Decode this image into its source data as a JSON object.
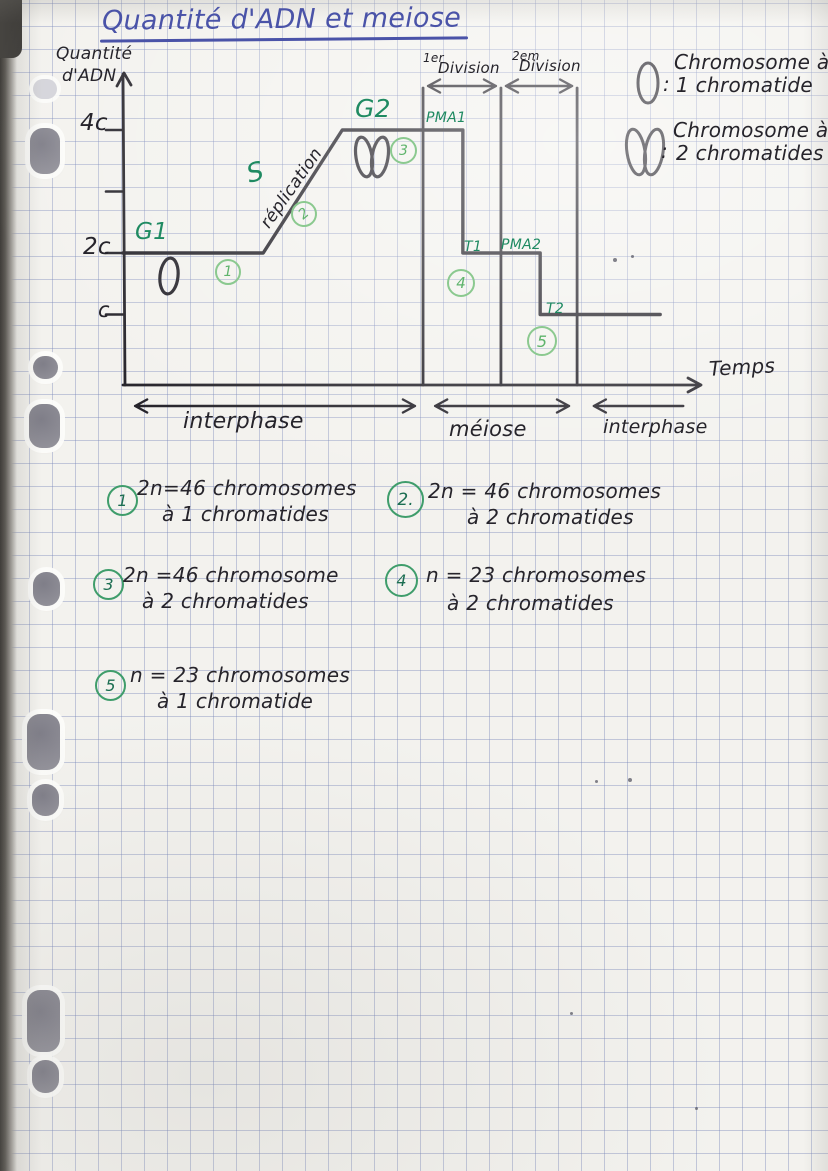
{
  "title": "Quantité d'ADN et meiose",
  "y_axis": {
    "label_line1": "Quantité",
    "label_line2": "d'ADN",
    "tick_labels": [
      "4c",
      "2c",
      "c"
    ]
  },
  "x_axis": {
    "label": "Temps"
  },
  "divisions": [
    {
      "ordinal": "1er",
      "word": "Division"
    },
    {
      "ordinal": "2em",
      "word": "Division"
    }
  ],
  "phases": {
    "g1": "G1",
    "s": "S",
    "replication": "réplication",
    "g2": "G2",
    "pma1": "PMA1",
    "t1": "T1",
    "pma2": "PMA2",
    "t2": "T2"
  },
  "spans": [
    {
      "label": "interphase"
    },
    {
      "label": "méiose"
    },
    {
      "label": "interphase"
    }
  ],
  "graph_marks": [
    "1",
    "2",
    "3",
    "4",
    "5"
  ],
  "legend": [
    {
      "symbol": "chromosome-1-chromatide",
      "separator": ":",
      "line1": "Chromosome à",
      "line2": "1 chromatide"
    },
    {
      "symbol": "chromosome-2-chromatides",
      "separator": ":",
      "line1": "Chromosome à",
      "line2": "2 chromatides"
    }
  ],
  "notes": [
    {
      "num": "1",
      "line1": "2n=46 chromosomes",
      "line2": "à 1 chromatides"
    },
    {
      "num": "2.",
      "line1": "2n = 46 chromosomes",
      "line2": "à 2 chromatides"
    },
    {
      "num": "3",
      "line1": "2n =46 chromosome",
      "line2": "à 2 chromatides"
    },
    {
      "num": "4",
      "line1": "n = 23 chromosomes",
      "line2": "à 2 chromatides"
    },
    {
      "num": "5",
      "line1": "n = 23 chromosomes",
      "line2": "à 1 chromatide"
    }
  ],
  "chart_data": {
    "type": "line",
    "title": "Quantité d'ADN et meiose",
    "xlabel": "Temps",
    "ylabel": "Quantité d'ADN",
    "y_ticks": [
      {
        "label": "4c",
        "value": 4
      },
      {
        "label": "",
        "value": 3
      },
      {
        "label": "2c",
        "value": 2
      },
      {
        "label": "c",
        "value": 1
      }
    ],
    "ylim": [
      0,
      4.8
    ],
    "x_unit": "temps (échelle arbitraire 0–100, non graduée)",
    "points": [
      [
        0,
        2
      ],
      [
        24.3,
        2
      ],
      [
        38,
        4
      ],
      [
        58.9,
        4
      ],
      [
        58.9,
        2
      ],
      [
        72.3,
        2
      ],
      [
        72.3,
        1
      ],
      [
        93.1,
        1
      ]
    ],
    "division_lines_x": [
      52,
      65.5,
      78.7
    ],
    "phase_segments": [
      {
        "label": "G1",
        "x1": 0,
        "x2": 24.3,
        "dna": "2C"
      },
      {
        "label": "S réplication",
        "x1": 24.3,
        "x2": 38,
        "dna": "2C→4C"
      },
      {
        "label": "G2",
        "x1": 38,
        "x2": 52,
        "dna": "4C"
      },
      {
        "label": "PMA1",
        "x1": 52,
        "x2": 58.9,
        "dna": "4C"
      },
      {
        "label": "T1",
        "x1": 58.9,
        "x2": 65.5,
        "dna": "2C"
      },
      {
        "label": "PMA2",
        "x1": 65.5,
        "x2": 72.3,
        "dna": "2C"
      },
      {
        "label": "T2",
        "x1": 72.3,
        "x2": 78.7,
        "dna": "C"
      },
      {
        "label": "interphase",
        "x1": 78.7,
        "x2": 93.1,
        "dna": "C"
      }
    ],
    "bottom_spans": [
      {
        "label": "interphase",
        "x1": 2.1,
        "x2": 50.6,
        "heads": "both"
      },
      {
        "label": "méiose",
        "x1": 54.1,
        "x2": 77.3,
        "heads": "both"
      },
      {
        "label": "interphase",
        "x1": 81.6,
        "x2": 97.1,
        "heads": "left"
      }
    ]
  },
  "colors": {
    "ink": "#26242b",
    "green": "#1f8a62",
    "light_green": "#8bc98f",
    "blue": "#4a53a8",
    "grid": "#a9b2cd",
    "paper": "#f3f2ee",
    "hole": "#8e8d96"
  }
}
